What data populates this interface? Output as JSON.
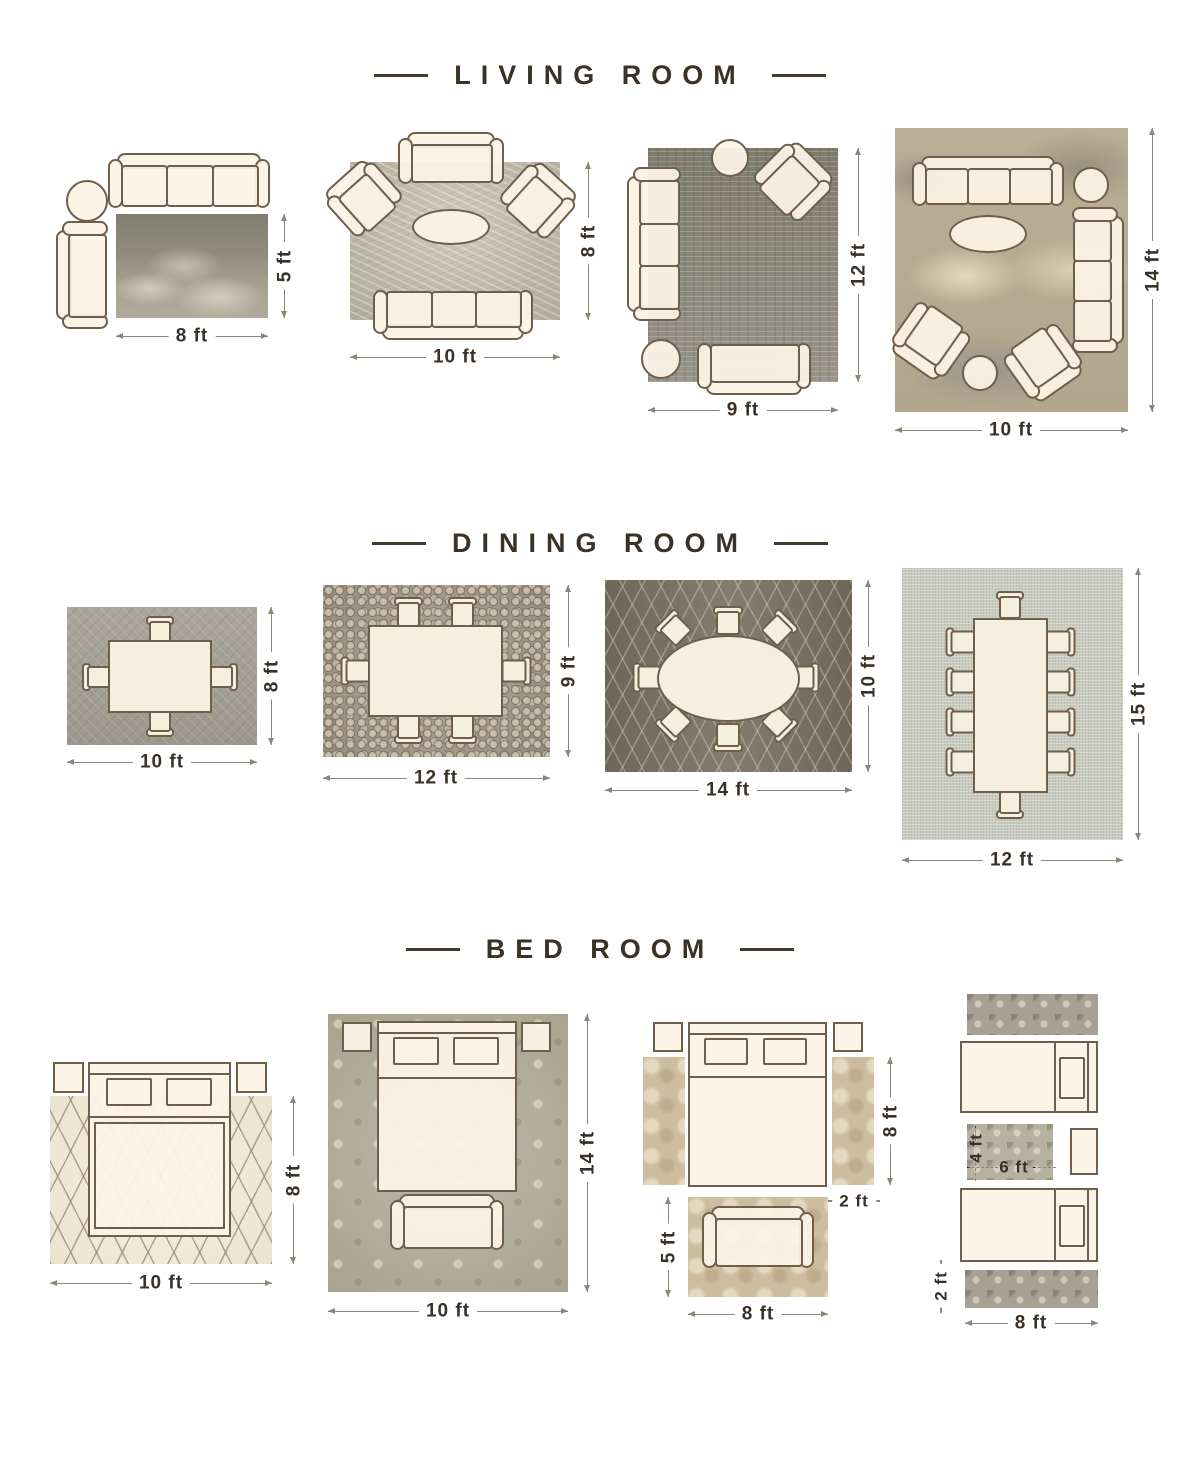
{
  "palette": {
    "furniture_fill": "#fbf2e4",
    "furniture_outline": "#6d5f4b",
    "dimension_line": "#8d8678",
    "dimension_text": "#38312a",
    "title_text": "#3b3126"
  },
  "sections": [
    {
      "title": "LIVING ROOM",
      "layouts": [
        {
          "name": "rug-8x5",
          "width_label": "8 ft",
          "height_label": "5 ft"
        },
        {
          "name": "rug-10x8",
          "width_label": "10 ft",
          "height_label": "8 ft"
        },
        {
          "name": "rug-9x12",
          "width_label": "9 ft",
          "height_label": "12 ft"
        },
        {
          "name": "rug-10x14",
          "width_label": "10 ft",
          "height_label": "14 ft"
        }
      ]
    },
    {
      "title": "DINING ROOM",
      "layouts": [
        {
          "name": "rug-10x8",
          "width_label": "10 ft",
          "height_label": "8 ft"
        },
        {
          "name": "rug-12x9",
          "width_label": "12 ft",
          "height_label": "9 ft"
        },
        {
          "name": "rug-14x10",
          "width_label": "14 ft",
          "height_label": "10 ft"
        },
        {
          "name": "rug-12x15",
          "width_label": "12 ft",
          "height_label": "15 ft"
        }
      ]
    },
    {
      "title": "BED ROOM",
      "layouts": [
        {
          "name": "rug-10x8",
          "width_label": "10 ft",
          "height_label": "8 ft"
        },
        {
          "name": "rug-10x14",
          "width_label": "10 ft",
          "height_label": "14 ft"
        },
        {
          "name": "side-runners-and-foot-rug",
          "runner_height_label": "8 ft",
          "runner_width_label": "2 ft",
          "foot_rug_height_label": "5 ft",
          "foot_rug_width_label": "8 ft"
        },
        {
          "name": "twin-beds-runners",
          "middle_rug_height_label": "4 ft",
          "middle_rug_width_label": "6 ft",
          "runner_width_label": "2 ft",
          "runner_length_label": "8 ft"
        }
      ]
    }
  ]
}
